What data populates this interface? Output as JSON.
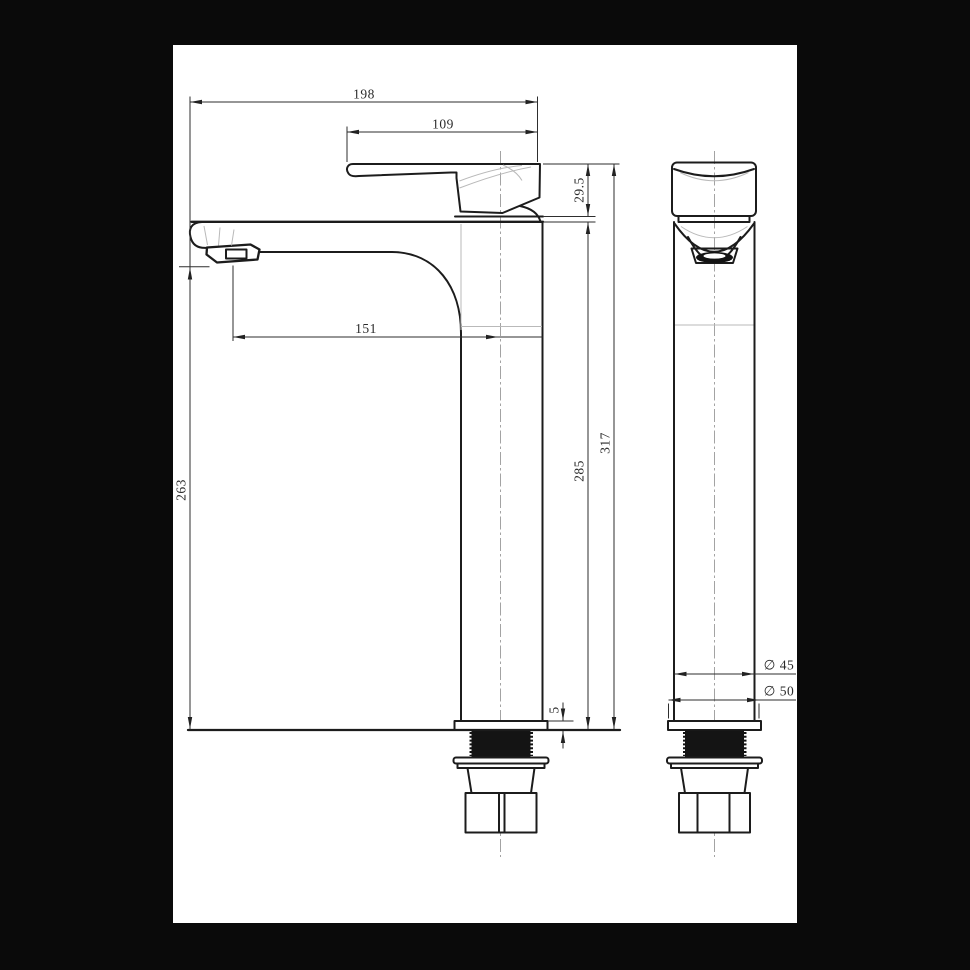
{
  "page": {
    "background": "#0a0a0a",
    "paper_color": "#ffffff"
  },
  "colors": {
    "object_line": "#1c1c1c",
    "dimension_line": "#2e2e2e",
    "construction_line": "#b9b9b9",
    "centerline": "#9a9a9a",
    "text": "#2a2a2a"
  },
  "drawing": {
    "dimensions": {
      "overall_length": "198",
      "handle_length": "109",
      "spout_reach": "151",
      "spout_outlet_height": "263",
      "handle_rise": "29.5",
      "body_height": "285",
      "overall_height": "317",
      "base_plate_thickness": "5",
      "body_diameter": "∅ 45",
      "base_diameter": "∅ 50"
    }
  }
}
